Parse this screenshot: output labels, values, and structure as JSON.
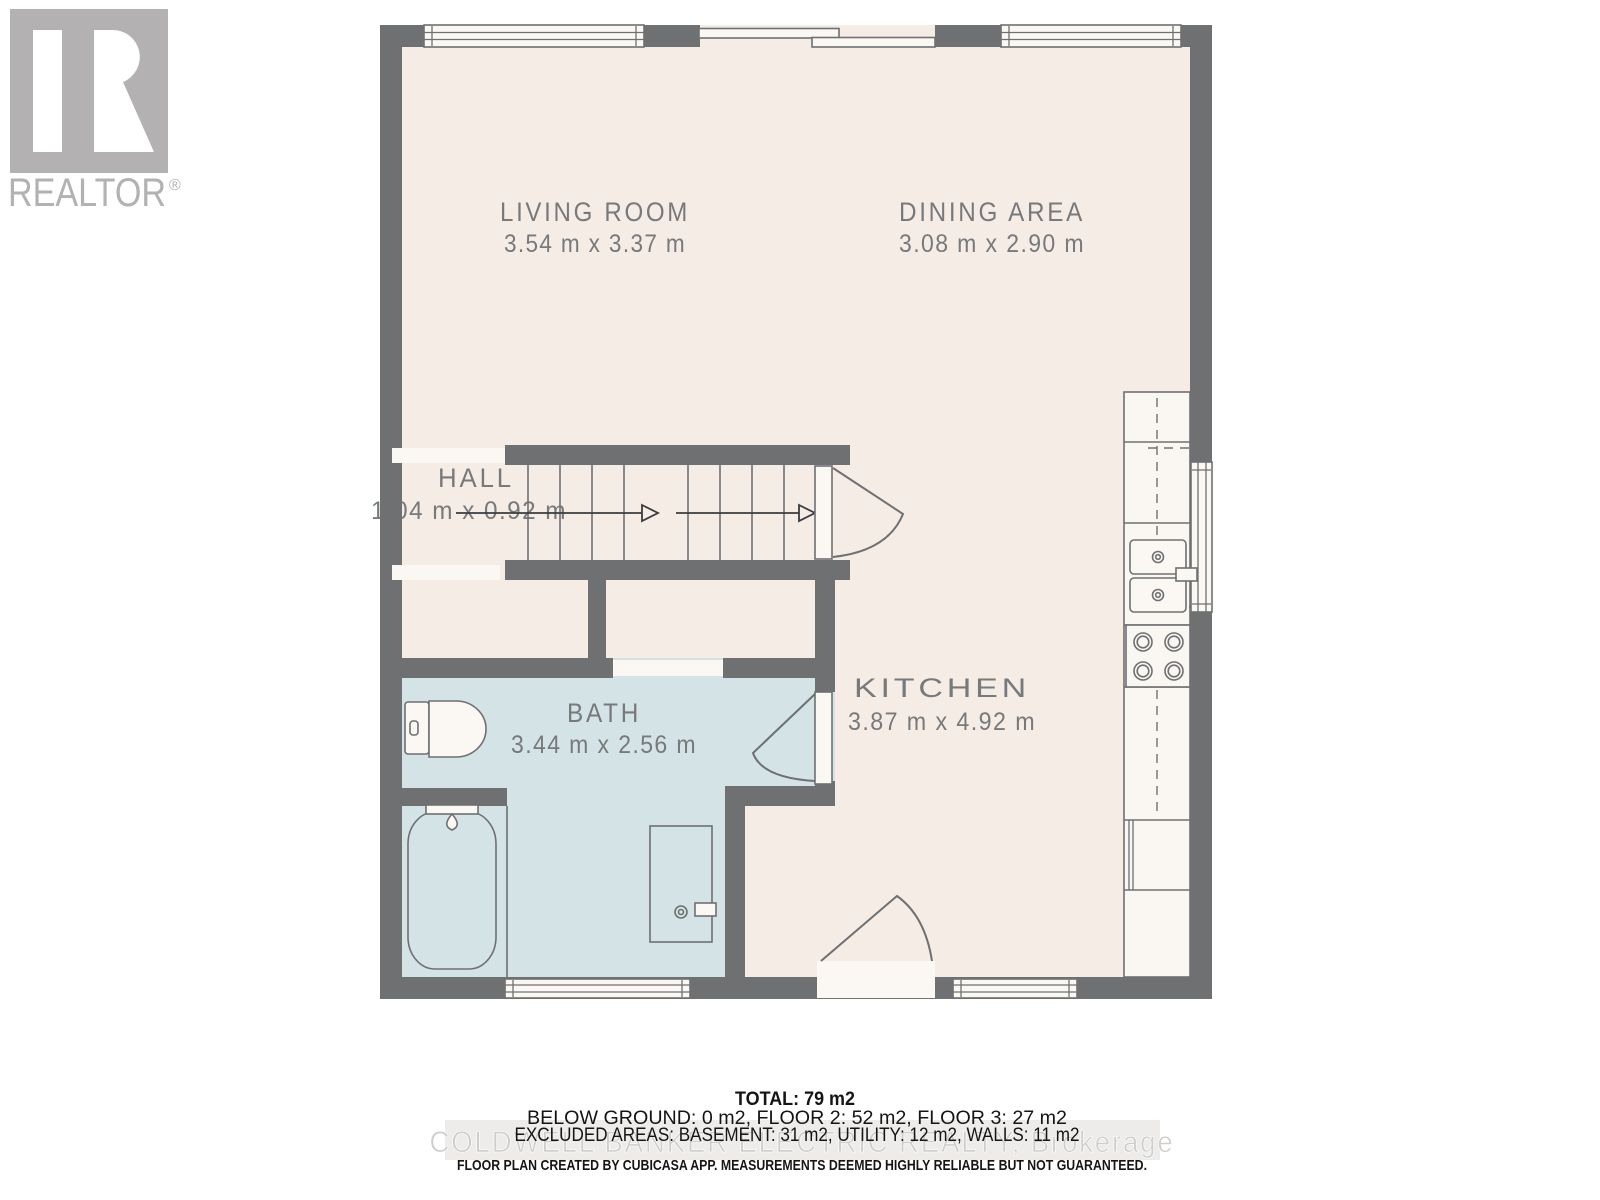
{
  "branding": {
    "logo_letter": "R",
    "logo_name": "REALTOR",
    "registered_mark": "®"
  },
  "rooms": {
    "living_room": {
      "name": "LIVING ROOM",
      "dims": "3.54 m x 3.37 m"
    },
    "dining_area": {
      "name": "DINING AREA",
      "dims": "3.08 m x 2.90 m"
    },
    "hall": {
      "name": "HALL",
      "dims": "1.04 m x 0.92 m"
    },
    "bath": {
      "name": "BATH",
      "dims": "3.44 m x 2.56 m"
    },
    "kitchen": {
      "name": "KITCHEN",
      "dims": "3.87 m x 4.92 m"
    }
  },
  "summary": {
    "total": "TOTAL: 79 m2",
    "floors": "BELOW GROUND: 0 m2, FLOOR 2: 52 m2, FLOOR 3: 27 m2",
    "excluded": "EXCLUDED AREAS: BASEMENT: 31 m2, UTILITY: 12 m2, WALLS: 11 m2"
  },
  "watermark": "COLDWELL BANKER ELECTRIC REALTY, Brokerage",
  "disclaimer": "FLOOR PLAN CREATED BY CUBICASA APP. MEASUREMENTS DEEMED HIGHLY RELIABLE BUT NOT GUARANTEED.",
  "colors": {
    "wall": "#6e7072",
    "floor": "#f6ece6",
    "bath_floor": "#d4e3e5",
    "fixture_white": "#fbf8f4",
    "label_text": "#77797b",
    "watermark_gray": "#cfcdcc",
    "logo_gray": "#b3b1b1"
  }
}
